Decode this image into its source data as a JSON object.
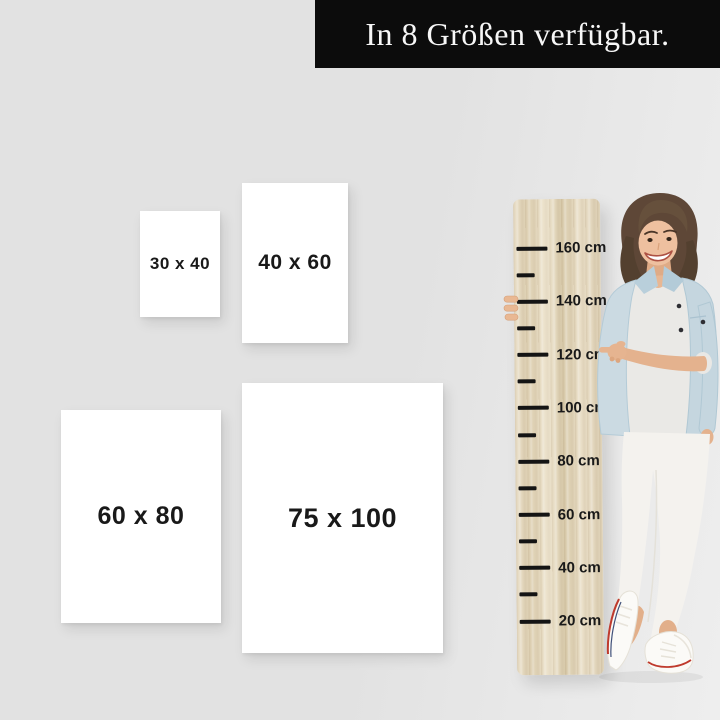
{
  "banner": {
    "text": "In 8 Größen verfügbar."
  },
  "sizes": [
    {
      "label": "30 x 40"
    },
    {
      "label": "40 x 60"
    },
    {
      "label": "60 x 80"
    },
    {
      "label": "75 x 100"
    }
  ],
  "ruler": {
    "unit": "cm",
    "ticks": [
      {
        "value": 160,
        "label": "160 cm",
        "major": true
      },
      {
        "value": 150,
        "label": "",
        "major": false
      },
      {
        "value": 140,
        "label": "140 cm",
        "major": true
      },
      {
        "value": 130,
        "label": "",
        "major": false
      },
      {
        "value": 120,
        "label": "120 cm",
        "major": true
      },
      {
        "value": 110,
        "label": "",
        "major": false
      },
      {
        "value": 100,
        "label": "100 cm",
        "major": true
      },
      {
        "value": 90,
        "label": "",
        "major": false
      },
      {
        "value": 80,
        "label": "80 cm",
        "major": true
      },
      {
        "value": 70,
        "label": "",
        "major": false
      },
      {
        "value": 60,
        "label": "60 cm",
        "major": true
      },
      {
        "value": 50,
        "label": "",
        "major": false
      },
      {
        "value": 40,
        "label": "40 cm",
        "major": true
      },
      {
        "value": 30,
        "label": "",
        "major": false
      },
      {
        "value": 20,
        "label": "20 cm",
        "major": true
      }
    ]
  },
  "figure": {
    "name": "woman-pointing-photo"
  },
  "colors": {
    "background": "#e2e2e2",
    "banner_bg": "#0c0c0c",
    "banner_text": "#f7f7f7",
    "box_bg": "#ffffff",
    "label_text": "#191919",
    "tick": "#141414",
    "wood_base": "#e4d8bf",
    "denim": "#c9d9e2",
    "skin": "#e6b490",
    "shoe_stripe": "#bf3a2d"
  }
}
